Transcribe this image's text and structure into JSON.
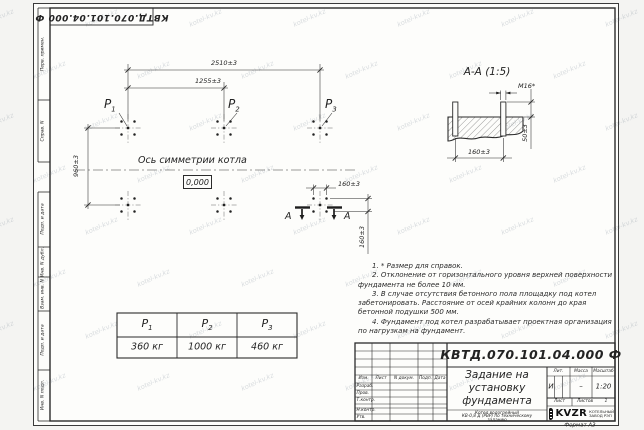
{
  "watermark": {
    "text": "kotel-kv.kz"
  },
  "designation": "КВТД.070.101.04.000 Ф",
  "frame": {
    "left_labels": [
      "Перв. примен.",
      "Справ. N",
      "Подп. и дата",
      "Инв. N дубл.",
      "Взам. инв. N",
      "Подп. и дата",
      "Инв. N подл."
    ],
    "format_note": "Формат А3"
  },
  "plan": {
    "dim_total": "2510±3",
    "dim_half": "1255±3",
    "dim_height": "960±3",
    "dim_bolt_x": "160±3",
    "dim_bolt_y": "160±3",
    "axis_label": "Ось симметрии котла",
    "level_mark": "0,000",
    "section_letter": "А",
    "points": [
      {
        "name": "P",
        "sub": "1"
      },
      {
        "name": "P",
        "sub": "2"
      },
      {
        "name": "P",
        "sub": "3"
      }
    ]
  },
  "section": {
    "title": "А-А (1:5)",
    "bolt_label": "М16*",
    "dim_height": "50±3",
    "dim_width": "160±3"
  },
  "load_table": {
    "headers": [
      {
        "name": "P",
        "sub": "1"
      },
      {
        "name": "P",
        "sub": "2"
      },
      {
        "name": "P",
        "sub": "3"
      }
    ],
    "values": [
      "360 кг",
      "1000 кг",
      "460 кг"
    ]
  },
  "notes": [
    "1. * Размер для справок.",
    "2. Отклонение от горизонтального уровня верхней поверхности фундамента не более 10 мм.",
    "3. В случае отсутствия бетонного пола площадку под котел забетонировать. Расстояние от осей крайних колонн до края бетонной подушки 500 мм.",
    "4. Фундамент под котел разрабатывает проектная организация по нагрузкам на фундамент."
  ],
  "title_block": {
    "designation": "КВТД.070.101.04.000  Ф",
    "title_lines": [
      "Задание на",
      "установку",
      "фундамента"
    ],
    "columns": [
      "Изм.",
      "Лист",
      "N докум.",
      "Подп.",
      "Дата"
    ],
    "rows": [
      "Разраб.",
      "Пров.",
      "Т.контр.",
      "Н.контр.",
      "Утв."
    ],
    "lit_header": "Лит.",
    "lit_value": "И",
    "mass_header": "Масса",
    "mass_value": "–",
    "scale_header": "Масштаб",
    "scale_value": "1:20",
    "sheet_header": "Лист",
    "sheets_header": "Листов",
    "sheets_value": "1",
    "product_lines": [
      "Котел водогрейный",
      "КВ-0,8 Д (РВР) по техническому",
      "заданию"
    ],
    "company": {
      "logo": "KVZR",
      "name_line1": "КОТЕЛЬНЫЙ",
      "name_line2": "ЗАВОД РЭП"
    }
  }
}
